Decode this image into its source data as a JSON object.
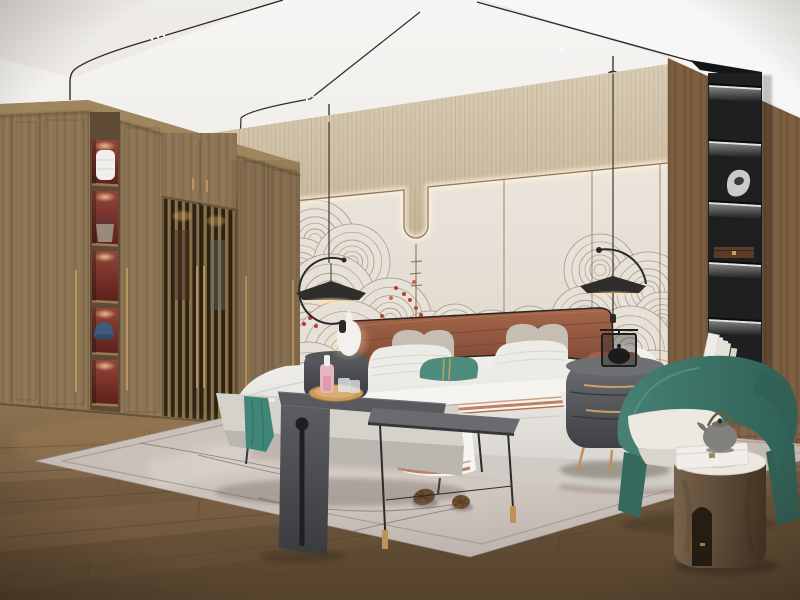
{
  "scene": {
    "type": "interior-photograph",
    "room": "bedroom",
    "style": "modern chinese zen / japandi hotel bedroom",
    "description": "Photoreal render of a modern Chinese-style bedroom: wooden wardrobe with lattice doors and lit display niches on the left, cream feature wall with swirling ink mural and red blossoms behind a terracotta leather bed, two black pendant lamps, black shelving niche in a wood column on the right, teal armchair with wooden drum side table, gray bench and side tables at the bed foot, pale rug with pine cones over plank flooring.",
    "objects": [
      {
        "name": "ceiling-track-lights",
        "color_ref": "rail"
      },
      {
        "name": "wardrobe",
        "color_ref": "wood"
      },
      {
        "name": "lattice-doors",
        "color_ref": "latticeBar"
      },
      {
        "name": "display-niches",
        "color_ref": "nicheRed",
        "count": 5,
        "contents": [
          "white-vase",
          "handbag",
          "empty",
          "blue-cap",
          "empty"
        ]
      },
      {
        "name": "feature-wall",
        "color_ref": "panel"
      },
      {
        "name": "swirl-mural",
        "color_ref": "swirlA"
      },
      {
        "name": "red-blossoms",
        "color_ref": "berry"
      },
      {
        "name": "pendant-lamp-left",
        "color_ref": "black"
      },
      {
        "name": "pendant-lamp-right",
        "color_ref": "black"
      },
      {
        "name": "bed",
        "color_ref": "bedWhite"
      },
      {
        "name": "headboard",
        "color_ref": "headboard"
      },
      {
        "name": "pillows",
        "colors": [
          "pillowGray",
          "pillowWhite",
          "pillowTeal",
          "bolster"
        ]
      },
      {
        "name": "striped-throw-blanket",
        "color_ref": "blanketStripe"
      },
      {
        "name": "nightstand-left",
        "color_ref": "charcoal"
      },
      {
        "name": "table-lamp-gourd",
        "color_ref": "lampWhite"
      },
      {
        "name": "nightstand-right",
        "color_ref": "nightstand"
      },
      {
        "name": "black-lantern",
        "color_ref": "black"
      },
      {
        "name": "bench",
        "color_ref": "bench"
      },
      {
        "name": "teal-throw",
        "color_ref": "throwTeal"
      },
      {
        "name": "saddle-table",
        "color_ref": "charcoal"
      },
      {
        "name": "wooden-tray",
        "color_ref": "tray"
      },
      {
        "name": "pink-decanter",
        "color_ref": "pinkBottle"
      },
      {
        "name": "metal-side-table",
        "color_ref": "metalTop"
      },
      {
        "name": "shelf-niche-black",
        "color_ref": "nicheBlack",
        "count": 5,
        "contents": [
          "empty",
          "silver-sculpture",
          "wooden-box",
          "empty",
          "white-books"
        ]
      },
      {
        "name": "armchair",
        "color_ref": "chairGreen"
      },
      {
        "name": "drum-side-table",
        "color_ref": "cylWood"
      },
      {
        "name": "teapot",
        "color_ref": "teapot"
      },
      {
        "name": "gift-box",
        "color_ref": "pillowWhite"
      },
      {
        "name": "books-leaning",
        "color_ref": "pillowWhite"
      },
      {
        "name": "rug",
        "color_ref": "rug"
      },
      {
        "name": "pine-cones",
        "color_ref": "pineCone",
        "count": 2
      },
      {
        "name": "plank-floor",
        "color_ref": "floor"
      }
    ]
  },
  "palette": {
    "ceiling": "#f1efec",
    "ceilingBright": "#f8f7f5",
    "ceilingShade": "#e7e4df",
    "rail": "#2e2d2b",
    "band": "#d5c9b2",
    "bandDark": "#c3b49a",
    "panel": "#e7e1d7",
    "panelDark": "#dcd4c8",
    "bronze": "#8a6a50",
    "ledWarm": "#fff4d8",
    "swirlA": "#968c80",
    "swirlB": "#a79d90",
    "berry": "#b8402b",
    "berry2": "#d2663c",
    "wood": "#8d7454",
    "woodDark": "#6e573c",
    "cornice": "#a0875f",
    "latticeBg": "#2c2315",
    "latticeBar": "#876d46",
    "nicheRed": "#7c2f2a",
    "brass": "#c9a066",
    "colWood": "#7b5d40",
    "nicheBlack": "#1d1f21",
    "floor": "#7c6244",
    "floorDark": "#55422d",
    "floorLight": "#977b55",
    "rug": "#cfc6bf",
    "rugLine": "#8f8680",
    "bedWhite": "#f0eeea",
    "bedShade": "#d7d4cf",
    "blanketStripe": "#bd8263",
    "headboard": "#9a5a40",
    "piping": "#2e2721",
    "pillowGray": "#c6beb3",
    "pillowWhite": "#edebe6",
    "pillowTeal": "#4e8b7c",
    "tealBand": "#c9a55e",
    "bolster": "#a2604a",
    "bench": "#d5d2cc",
    "throwTeal": "#3f8578",
    "charcoal": "#54555a",
    "charcoalDark": "#3c3d41",
    "metalTop": "#696b6f",
    "metalLeg": "#2a2b2d",
    "tray": "#c9995d",
    "pinkBottle": "#e6b6c0",
    "nightstand": "#5c5e62",
    "chairGreen": "#3f7b6b",
    "chairGreenDark": "#2f6156",
    "cushion": "#ece9e1",
    "cylWood": "#67543f",
    "marble": "#ece7df",
    "teapot": "#82807b",
    "lampWhite": "#f3f1ed",
    "black": "#262625",
    "pineCone": "#7a573a",
    "pineDark": "#4e3722",
    "glow": "#ffd9a0"
  },
  "mural": {
    "ring_color_a": "#968c80",
    "ring_color_b": "#a79d90",
    "fill": "#e7e1d7",
    "mounds": [
      [
        315,
        240,
        40
      ],
      [
        300,
        272,
        34
      ],
      [
        352,
        262,
        38
      ],
      [
        330,
        300,
        46
      ],
      [
        390,
        320,
        42
      ],
      [
        308,
        335,
        40
      ],
      [
        345,
        352,
        52
      ],
      [
        308,
        390,
        48
      ],
      [
        412,
        372,
        40
      ],
      [
        370,
        398,
        50
      ],
      [
        430,
        345,
        34
      ],
      [
        600,
        270,
        36
      ],
      [
        648,
        292,
        40
      ],
      [
        585,
        320,
        34
      ],
      [
        662,
        322,
        30
      ],
      [
        630,
        350,
        44
      ],
      [
        600,
        382,
        40
      ],
      [
        655,
        392,
        42
      ],
      [
        455,
        330,
        26
      ],
      [
        492,
        340,
        30
      ],
      [
        530,
        332,
        26
      ],
      [
        560,
        346,
        30
      ]
    ],
    "berries": [
      [
        396,
        288
      ],
      [
        404,
        294
      ],
      [
        410,
        300
      ],
      [
        391,
        298
      ],
      [
        416,
        308
      ],
      [
        421,
        315
      ],
      [
        382,
        316
      ],
      [
        375,
        322
      ],
      [
        388,
        325
      ],
      [
        348,
        325
      ],
      [
        342,
        331
      ],
      [
        356,
        333
      ],
      [
        310,
        318
      ],
      [
        304,
        324
      ],
      [
        316,
        326
      ],
      [
        414,
        282
      ]
    ]
  },
  "decor": {
    "planks": {
      "vpx": 1600,
      "vpy": 395,
      "yl": [
        448,
        473,
        503,
        538,
        577,
        612
      ],
      "ticks": [
        [
          120,
          470
        ],
        [
          340,
          452
        ],
        [
          520,
          452
        ],
        [
          660,
          470
        ],
        [
          90,
          560
        ],
        [
          280,
          525
        ],
        [
          430,
          505
        ],
        [
          610,
          500
        ],
        [
          720,
          478
        ],
        [
          200,
          500
        ],
        [
          560,
          535
        ],
        [
          700,
          540
        ],
        [
          150,
          430
        ],
        [
          460,
          436
        ]
      ]
    },
    "ledShelves": [
      86,
      142,
      203,
      263,
      320
    ],
    "wardNiches": [
      [
        140,
        184
      ],
      [
        191,
        244
      ],
      [
        251,
        301
      ],
      [
        308,
        353
      ],
      [
        360,
        404
      ]
    ],
    "pills": [
      [
        258,
        399
      ],
      [
        271,
        400
      ],
      [
        284,
        401
      ],
      [
        352,
        405
      ],
      [
        368,
        406
      ],
      [
        384,
        407
      ],
      [
        400,
        408
      ],
      [
        436,
        410
      ]
    ],
    "rugStreaks": [
      "M140,443 Q230,458 305,474",
      "M198,455 Q250,468 318,482",
      "M258,498 Q360,522 468,502",
      "M318,540 Q395,520 468,506"
    ]
  }
}
